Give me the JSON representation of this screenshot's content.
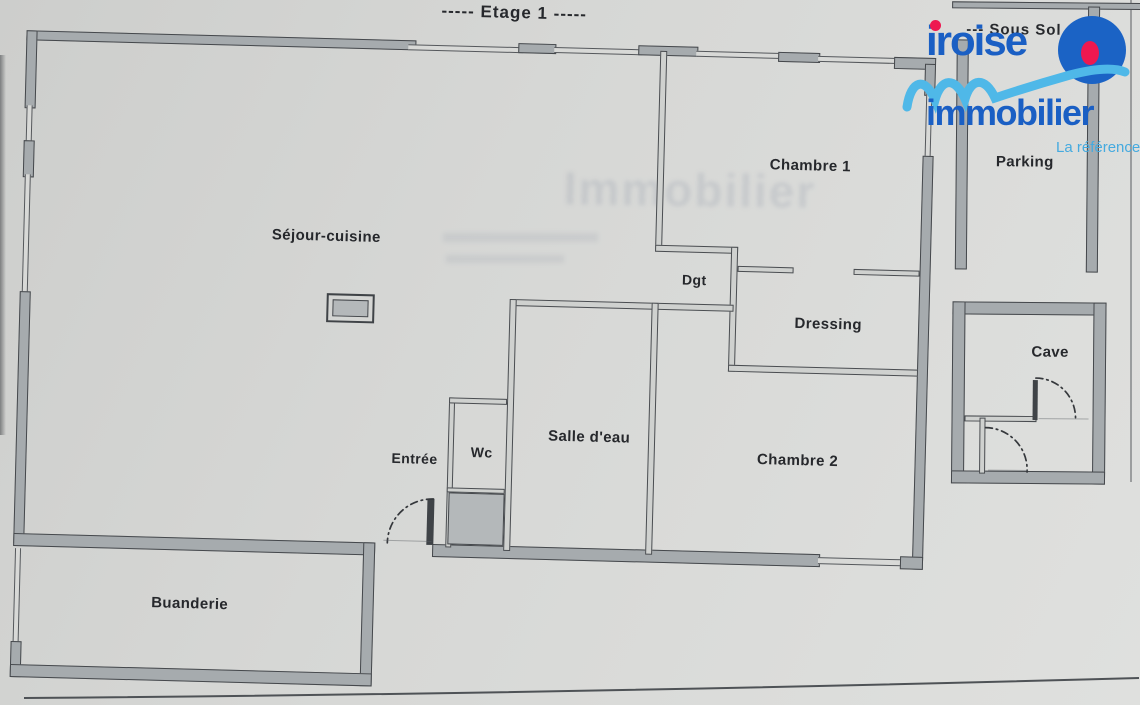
{
  "titles": {
    "floor": "----- Etage 1 -----",
    "basement": "--- Sous Sol"
  },
  "rooms": {
    "sejour": "Séjour-cuisine",
    "chambre1": "Chambre 1",
    "dgt": "Dgt",
    "dressing": "Dressing",
    "salle_eau": "Salle d'eau",
    "wc": "Wc",
    "entree": "Entrée",
    "chambre2": "Chambre 2",
    "buanderie": "Buanderie",
    "parking": "Parking",
    "cave": "Cave"
  },
  "logo": {
    "brand_top": "iroise",
    "brand_bottom": "immobilier",
    "tagline": "La référence"
  },
  "watermark": "Immobilier",
  "colors": {
    "paper": "#d6d7d5",
    "wall_fill": "#a6abae",
    "wall_outline": "#45484c",
    "interior_wall_fill": "#cfd1cf",
    "label_ink": "#26282c",
    "logo_blue": "#1a5fc4",
    "logo_light_blue": "#4fb8e8",
    "logo_red": "#ee1850"
  }
}
